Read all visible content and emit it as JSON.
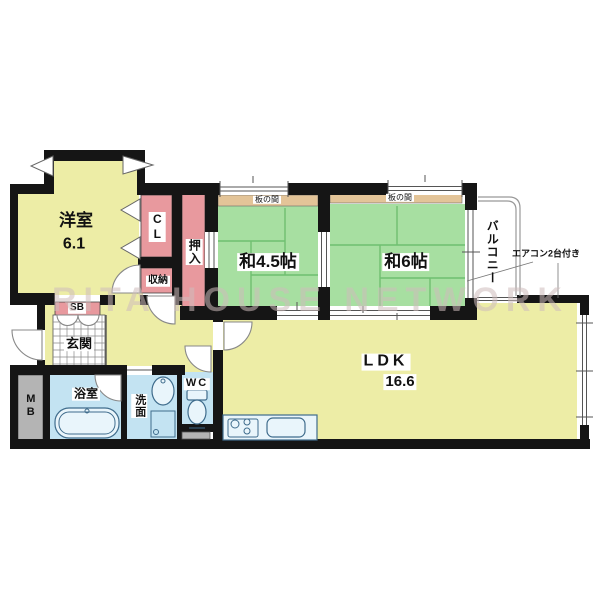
{
  "colors": {
    "wall": "#151515",
    "room_yellow": "#ededa6",
    "tatami_green": "#a7dfa1",
    "tatami_line": "#6fbf70",
    "closet_pink": "#e8999e",
    "itanoma_tan": "#e3c498",
    "wet_blue": "#c3e3f2",
    "fixture_blue": "#e9f5fb",
    "fixture_stroke": "#3f6c8c",
    "gray_box": "#b4b4b4",
    "grid_line": "#8a8a8a",
    "line_gray": "#888888",
    "watermark_color": "rgba(205,188,188,0.55)"
  },
  "floorplan": {
    "watermark": "RITA HOUSE NETWORK",
    "rooms": {
      "western_room": {
        "name": "洋室",
        "size": "6.1"
      },
      "japanese_room_45": {
        "name": "和4.5帖"
      },
      "japanese_room_6": {
        "name": "和6帖"
      },
      "ldk": {
        "name": "LDK",
        "size": "16.6"
      },
      "balcony": {
        "name": "バルコニー"
      },
      "entrance": {
        "name": "玄関"
      },
      "bathroom": {
        "name": "浴室"
      },
      "washroom": {
        "name": "洗面"
      },
      "toilet": {
        "name": "WC"
      }
    },
    "storage": {
      "closet": "CL",
      "oshiire": "押入",
      "shuno": "収納",
      "shoe_box": "SB",
      "meter_box": "MB",
      "itanoma": "板の間"
    },
    "notes": {
      "aircon": "エアコン2台付き"
    }
  }
}
